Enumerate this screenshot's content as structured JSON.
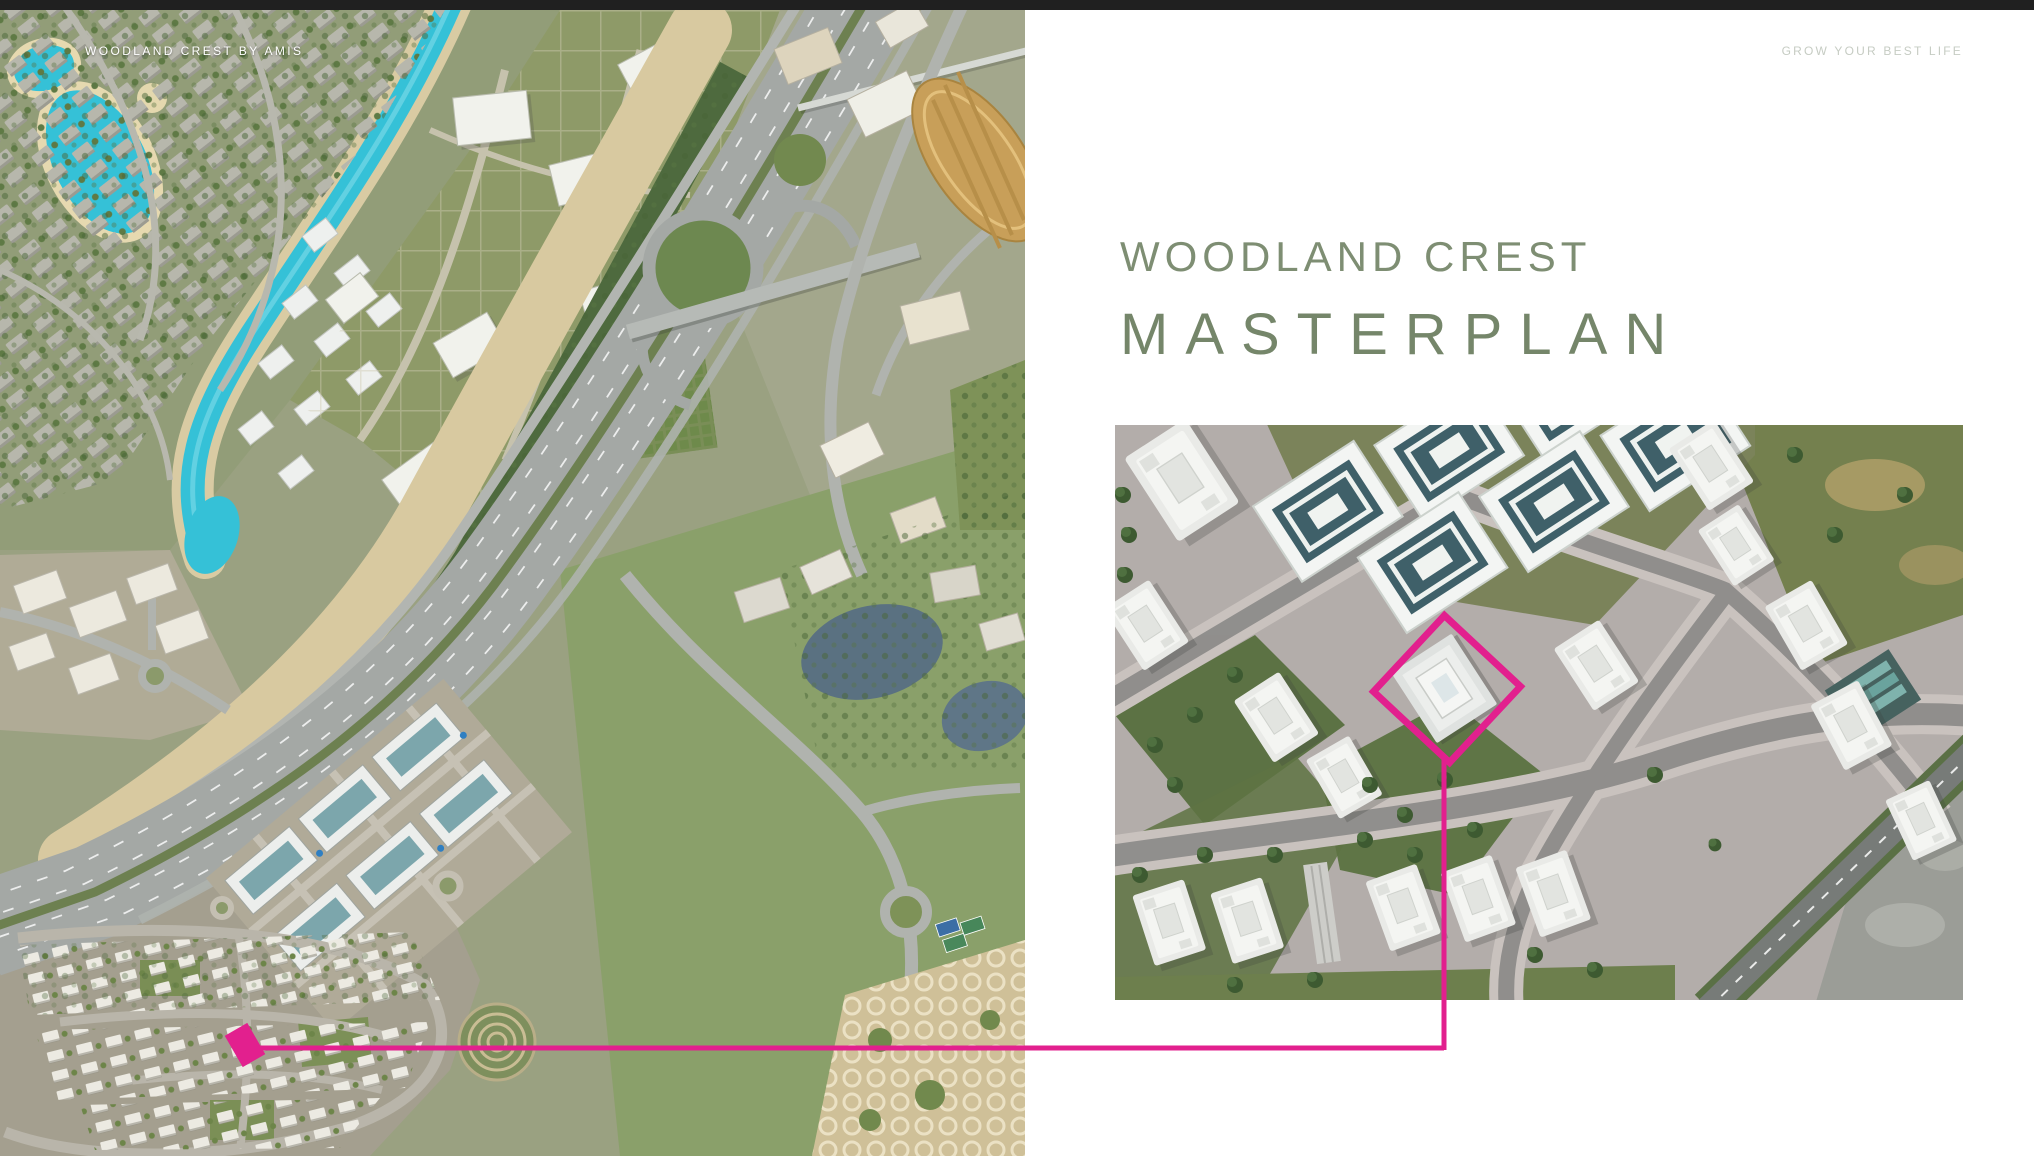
{
  "page": {
    "width": 2034,
    "height": 1156,
    "topbar_color": "#202020",
    "panel_background": "#ffffff"
  },
  "header": {
    "brand": "WOODLAND CREST BY AMIS",
    "tagline": "GROW YOUR BEST LIFE"
  },
  "title": {
    "line1": "WOODLAND CREST",
    "line2": "MASTERPLAN"
  },
  "colors": {
    "accent_pink": "#e2208e",
    "title_green_line1": "#7e8e73",
    "title_green_line2": "#75866a",
    "tagline_gray": "#c6ccc3",
    "canal_water": "#35c1d7",
    "topbar": "#202020"
  },
  "map": {
    "kind": "satellite-aerial-map",
    "marker": "highlighted-plot"
  },
  "inset": {
    "kind": "masterplan-3d-render",
    "marker": "highlighted-building-outline"
  }
}
